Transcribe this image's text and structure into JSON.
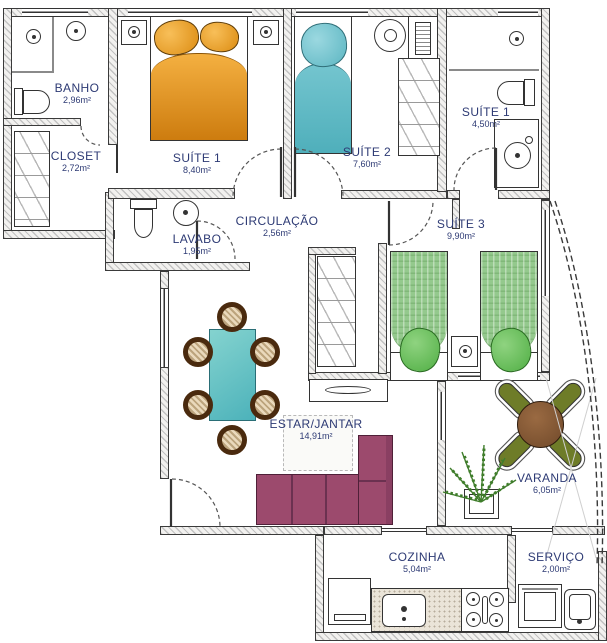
{
  "colors": {
    "label_text": "#2d3a74",
    "wall_hatch": "#c2c2c2",
    "wall_outline": "#3a3a3a",
    "suite1_bed_orange": "#e08c15",
    "suite2_bed_teal": "#5cb6c2",
    "suite3_bed_green": "#94c98d",
    "dining_table_teal": "#4cb2ba",
    "sofa_plum": "#9c4a6d",
    "varanda_table_brown": "#8a5e3c",
    "varanda_chair_olive": "#6e7c28",
    "plant_green": "#3f7d2b"
  },
  "rooms": {
    "banho": {
      "label": "BANHO",
      "area": "2,96m²"
    },
    "closet": {
      "label": "CLOSET",
      "area": "2,72m²"
    },
    "suite1": {
      "label": "SUÍTE 1",
      "area": "8,40m²"
    },
    "suite2": {
      "label": "SUÍTE 2",
      "area": "7,60m²"
    },
    "suite1_banheiro": {
      "label": "SUÍTE 1",
      "area": "4,50m²"
    },
    "lavabo": {
      "label": "LAVABO",
      "area": "1,95m²"
    },
    "circulacao": {
      "label": "CIRCULAÇÃO",
      "area": "2,56m²"
    },
    "suite3": {
      "label": "SUÍTE 3",
      "area": "9,90m²"
    },
    "estar_jantar": {
      "label": "ESTAR/JANTAR",
      "area": "14,91m²"
    },
    "varanda": {
      "label": "VARANDA",
      "area": "6,05m²"
    },
    "cozinha": {
      "label": "COZINHA",
      "area": "5,04m²"
    },
    "servico": {
      "label": "SERVIÇO",
      "area": "2,00m²"
    }
  }
}
